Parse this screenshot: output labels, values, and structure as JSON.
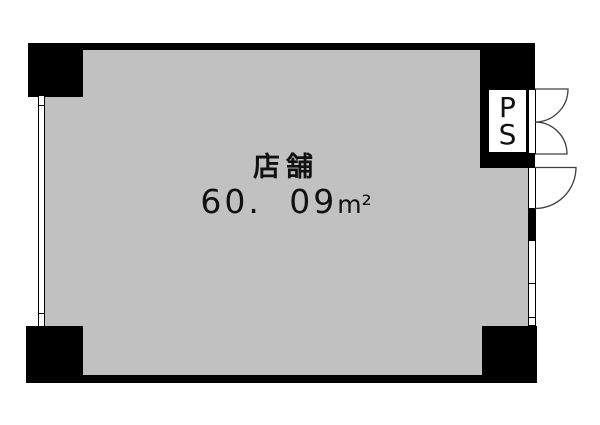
{
  "floorplan": {
    "room": {
      "name": "店舗",
      "area": "60. 09",
      "area_unit": "m²"
    },
    "ps": {
      "line1": "P",
      "line2": "S"
    },
    "colors": {
      "wall": "#000000",
      "floor": "#c1c1c1",
      "door_line": "#3f3f3f",
      "background": "#ffffff"
    }
  }
}
